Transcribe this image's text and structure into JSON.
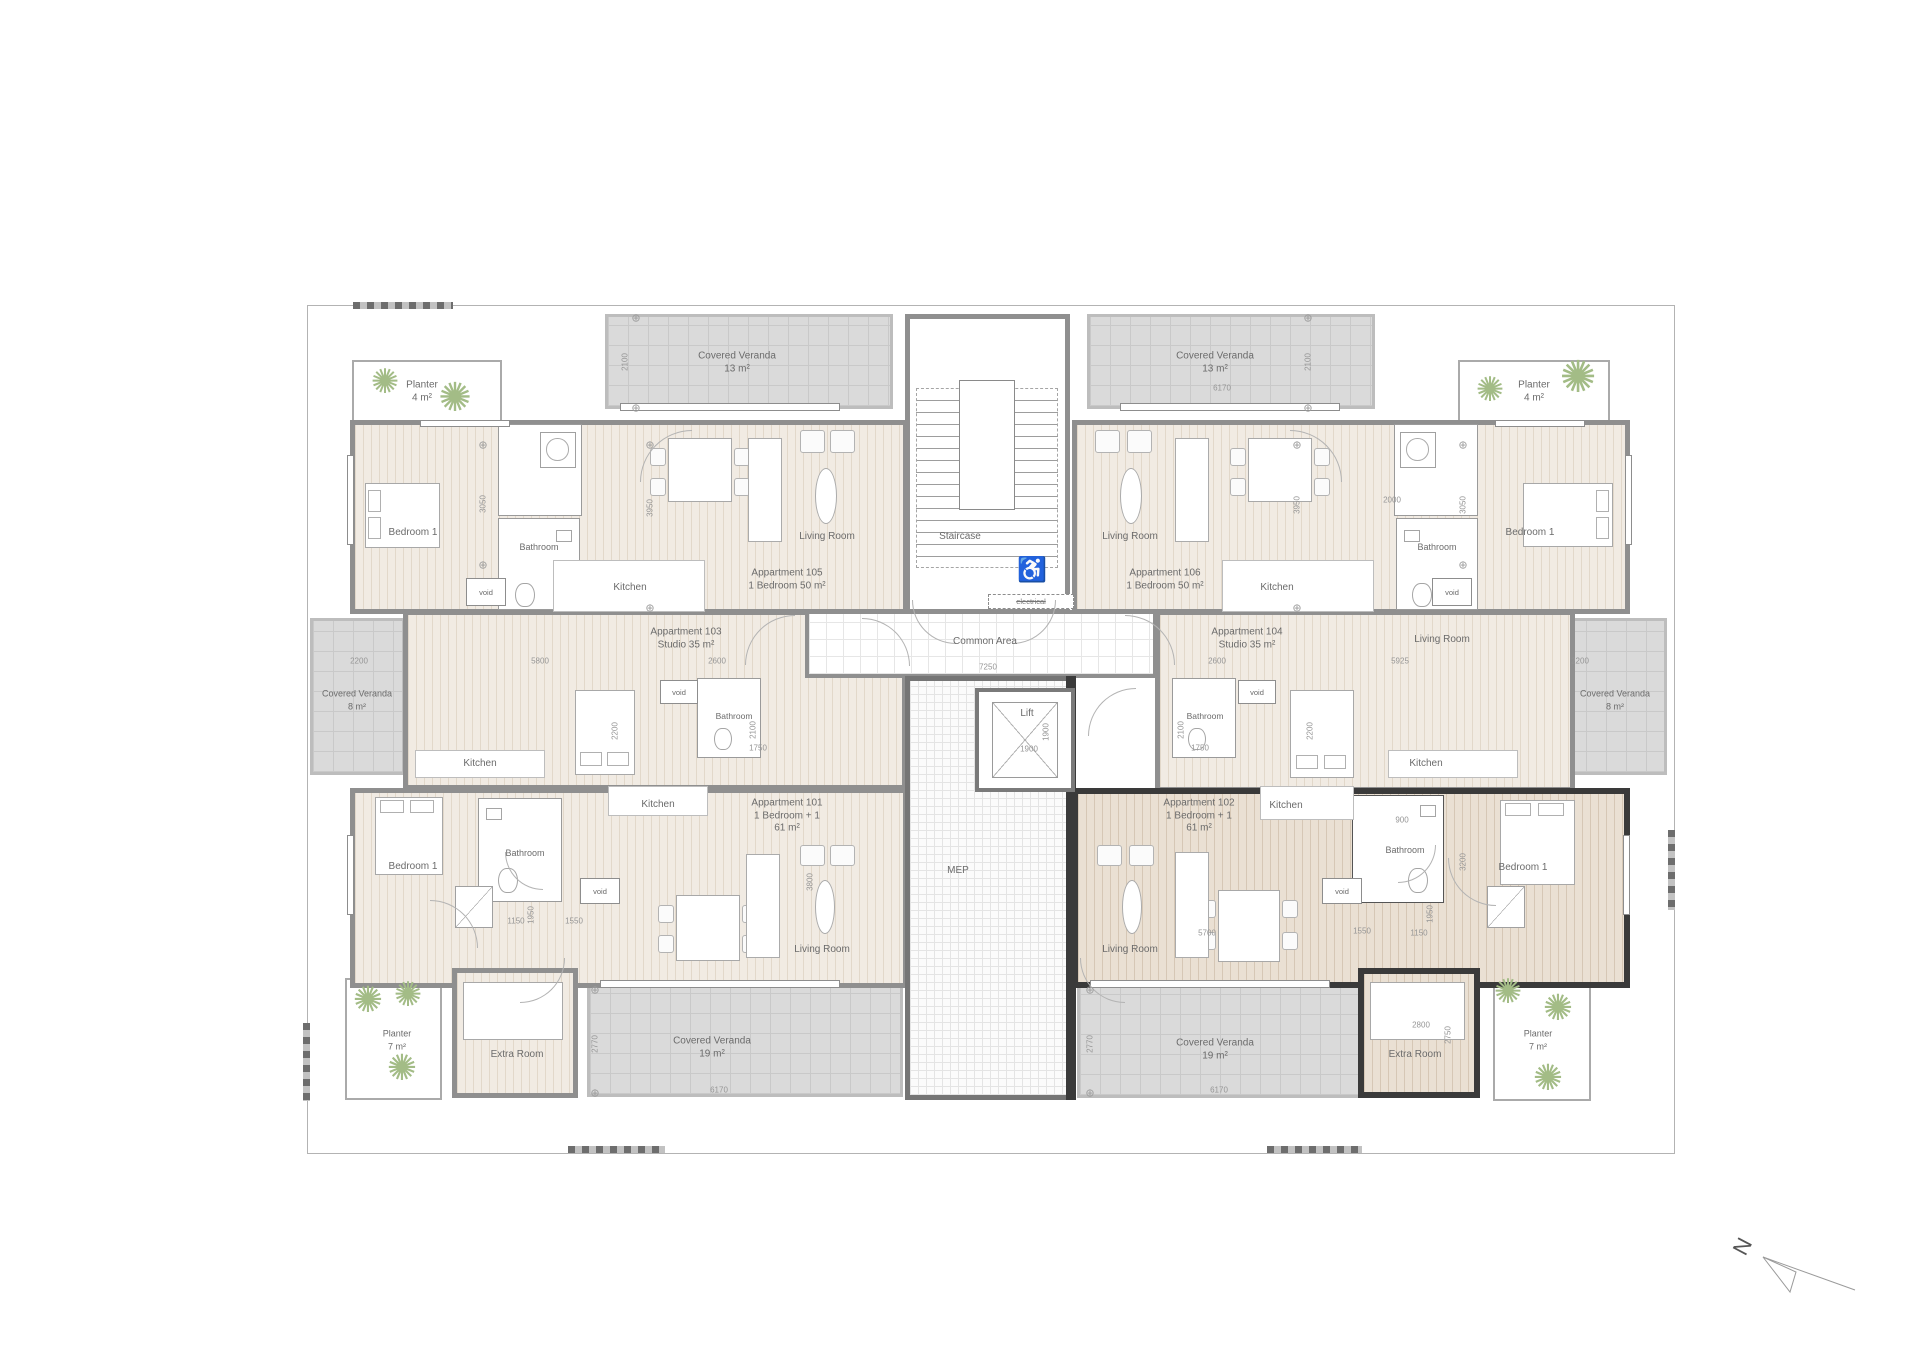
{
  "apartments": {
    "a105": {
      "name": "Appartment 105",
      "type": "1 Bedroom 50 m²"
    },
    "a106": {
      "name": "Appartment 106",
      "type": "1 Bedroom 50 m²"
    },
    "a103": {
      "name": "Appartment 103",
      "type": "Studio 35 m²"
    },
    "a104": {
      "name": "Appartment 104",
      "type": "Studio 35 m²"
    },
    "a101": {
      "name": "Appartment 101",
      "type": "1 Bedroom + 1",
      "area": "61 m²"
    },
    "a102": {
      "name": "Appartment 102",
      "type": "1 Bedroom + 1",
      "area": "61 m²"
    }
  },
  "rooms": {
    "living_room": "Living Room",
    "kitchen": "Kitchen",
    "bathroom": "Bathroom",
    "bedroom1": "Bedroom 1",
    "staircase": "Staircase",
    "common_area": "Common Area",
    "lift": "Lift",
    "mep": "MEP",
    "extra_room": "Extra Room",
    "void": "void",
    "electrical": "electrical"
  },
  "outdoor": {
    "veranda13": {
      "name": "Covered Veranda",
      "area": "13 m²"
    },
    "veranda8": {
      "name": "Covered Veranda",
      "area": "8 m²"
    },
    "veranda19": {
      "name": "Covered Veranda",
      "area": "19 m²"
    },
    "planter4": {
      "name": "Planter",
      "area": "4 m²"
    },
    "planter7": {
      "name": "Planter",
      "area": "7 m²"
    }
  },
  "dimensions": {
    "d2100": "2100",
    "d6170": "6170",
    "d2200": "2200",
    "d2600": "2600",
    "d5800": "5800",
    "d5925": "5925",
    "d7250": "7250",
    "d1900": "1900",
    "d2000": "2000",
    "d3050": "3050",
    "d3950": "3950",
    "d1750": "1750",
    "d1150": "1150",
    "d1550": "1550",
    "d1950": "1950",
    "d900": "900",
    "d3200": "3200",
    "d5700": "5700",
    "d2770": "2770",
    "d2800": "2800",
    "d2750": "2750",
    "d3800": "3800"
  },
  "compass": {
    "north": "N"
  },
  "colors": {
    "wall": "#8f8f8f",
    "wall_highlight": "#3a3a3a",
    "floor": "#f1ebe3",
    "floor_highlight": "#eae0d3",
    "veranda": "#dadada"
  }
}
